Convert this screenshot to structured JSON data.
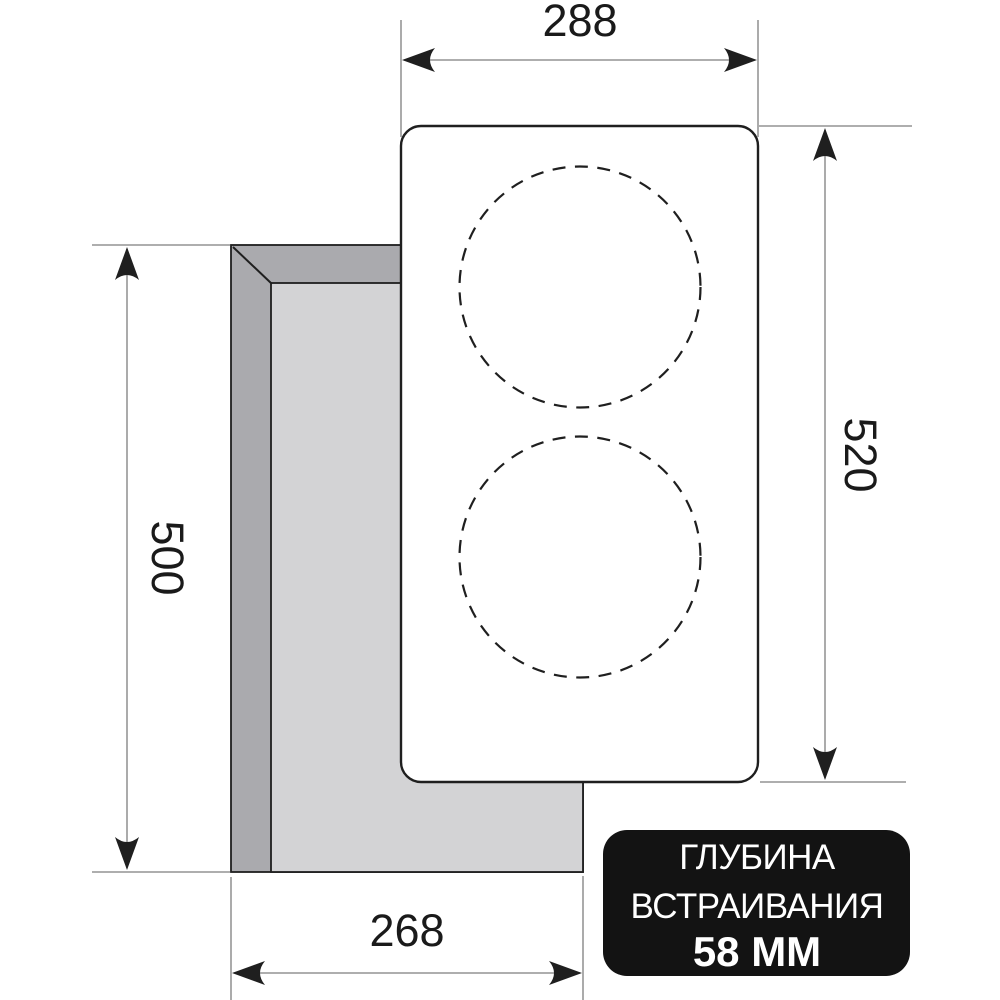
{
  "diagram": {
    "dimensions": {
      "panel_width_mm": "288",
      "panel_height_mm": "520",
      "cutout_height_mm": "500",
      "cutout_width_mm": "268"
    },
    "badge": {
      "line1": "ГЛУБИНА",
      "line2": "ВСТРАИВАНИЯ",
      "line3": "58 ММ"
    },
    "colors": {
      "background": "#ffffff",
      "outline": "#1f1f1f",
      "cutout_wall": "#aaaaae",
      "cutout_floor": "#d3d3d5",
      "panel_fill": "#ffffff",
      "dimension_line": "#7e7e7e",
      "text": "#1a1a1a",
      "badge_bg": "#131313",
      "badge_text": "#ffffff"
    }
  }
}
